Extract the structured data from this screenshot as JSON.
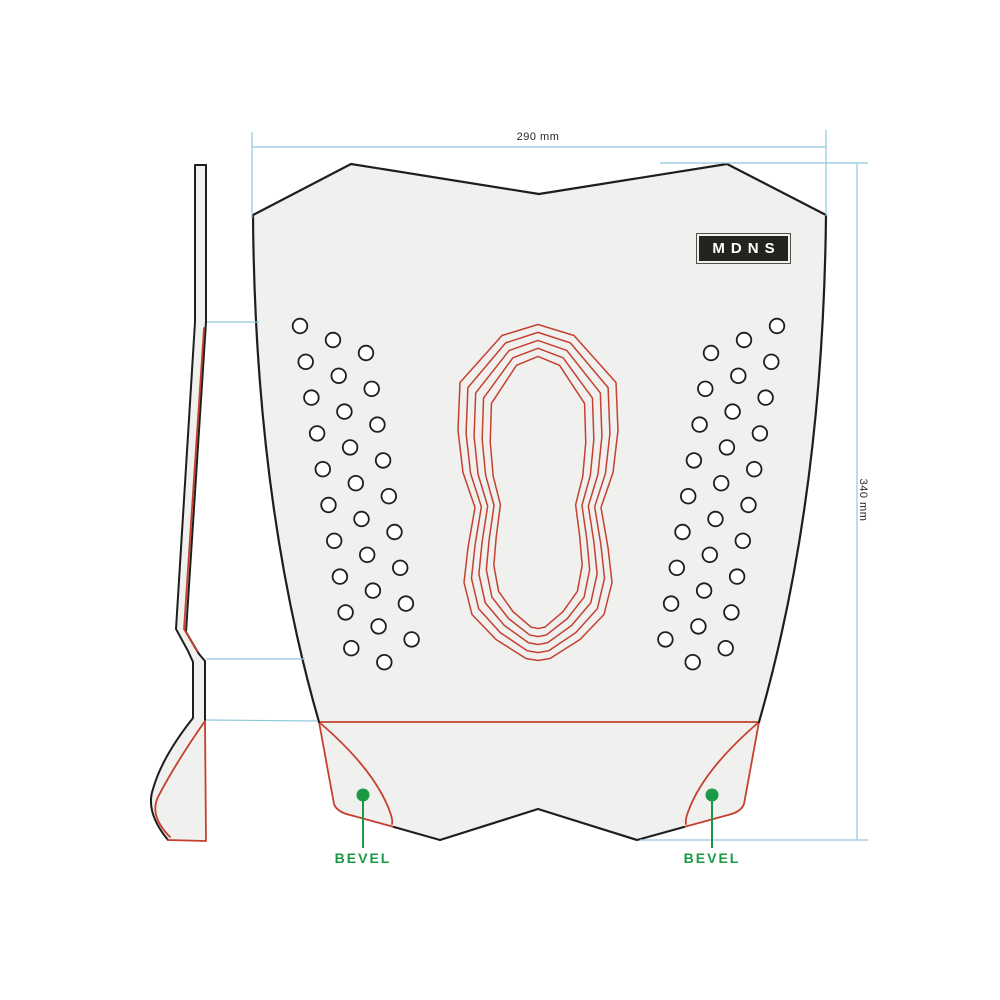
{
  "logo": {
    "text": "MDNS"
  },
  "dimensions": {
    "width_label": "290 mm",
    "height_label": "340 mm"
  },
  "annotations": {
    "bevel_left_label": "BEVEL",
    "bevel_right_label": "BEVEL"
  },
  "colors": {
    "outline": "#1e1e1e",
    "accent_red": "#c5402f",
    "accent_green": "#1b9a46",
    "dimension_blue": "#8fc8dd",
    "pad_fill": "#f0f0ee",
    "badge_bg": "#23241f",
    "badge_fg": "#ffffff"
  }
}
